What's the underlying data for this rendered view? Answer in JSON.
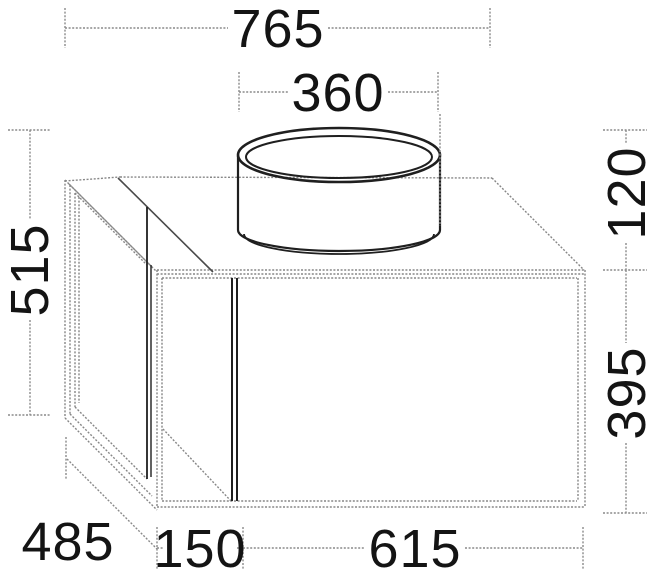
{
  "drawing": {
    "type": "technical-dimension-drawing",
    "colors": {
      "background": "#ffffff",
      "object_light": "#878787",
      "object_dark": "#1f1f1f",
      "interior_edge": "#4a4a4a",
      "dimension": "#8a8a8a",
      "text": "#141414"
    },
    "dimensions": {
      "overall_width": "765",
      "basin_diameter": "360",
      "overall_height": "515",
      "basin_height": "120",
      "body_height": "395",
      "depth": "485",
      "shelf_width": "150",
      "body_width": "615"
    }
  }
}
